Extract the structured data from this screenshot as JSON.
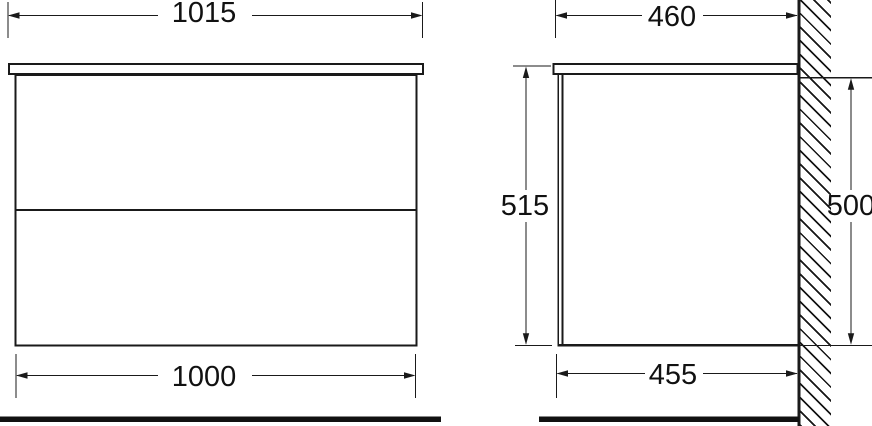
{
  "front_view": {
    "countertop_width_label": "1015",
    "cabinet_width_label": "1000"
  },
  "side_view": {
    "countertop_depth_label": "460",
    "cabinet_depth_label": "455",
    "overall_height_label": "515",
    "carcass_height_label": "500"
  },
  "colors": {
    "line": "#1a1a1a",
    "background": "#ffffff"
  }
}
